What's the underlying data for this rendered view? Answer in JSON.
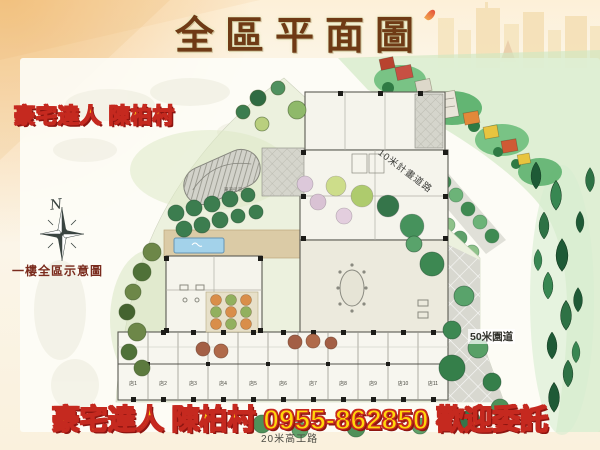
{
  "slide": {
    "title": "全區平面圖",
    "agent_badge": "豪宅達人 陳柏村",
    "bottom_banner": "豪宅達人 陳柏村 0955-862850 歡迎委託",
    "phone": "0955-862850"
  },
  "plan": {
    "caption": "一樓全區示意圖",
    "compass_north": "N",
    "roads": [
      {
        "label": "10米計畫道路"
      },
      {
        "label": "50米園道"
      },
      {
        "label": "20米高工路"
      }
    ],
    "driveway_label": "車道引道",
    "shop_units": [
      "店1",
      "店2",
      "店3",
      "店4",
      "店5",
      "店6",
      "店7",
      "店8",
      "店9",
      "店10",
      "店11"
    ]
  },
  "colors": {
    "title_text": "#6f3a15",
    "banner_text_fill": "#ffd60a",
    "banner_text_stroke": "#c5291f",
    "background_cream": "#fcf4e4",
    "site_lawn": "#ecf1de",
    "forest_green": "#4daa62",
    "pool_blue": "#a3d2ea",
    "plaza_gray": "#d8d8d0"
  }
}
